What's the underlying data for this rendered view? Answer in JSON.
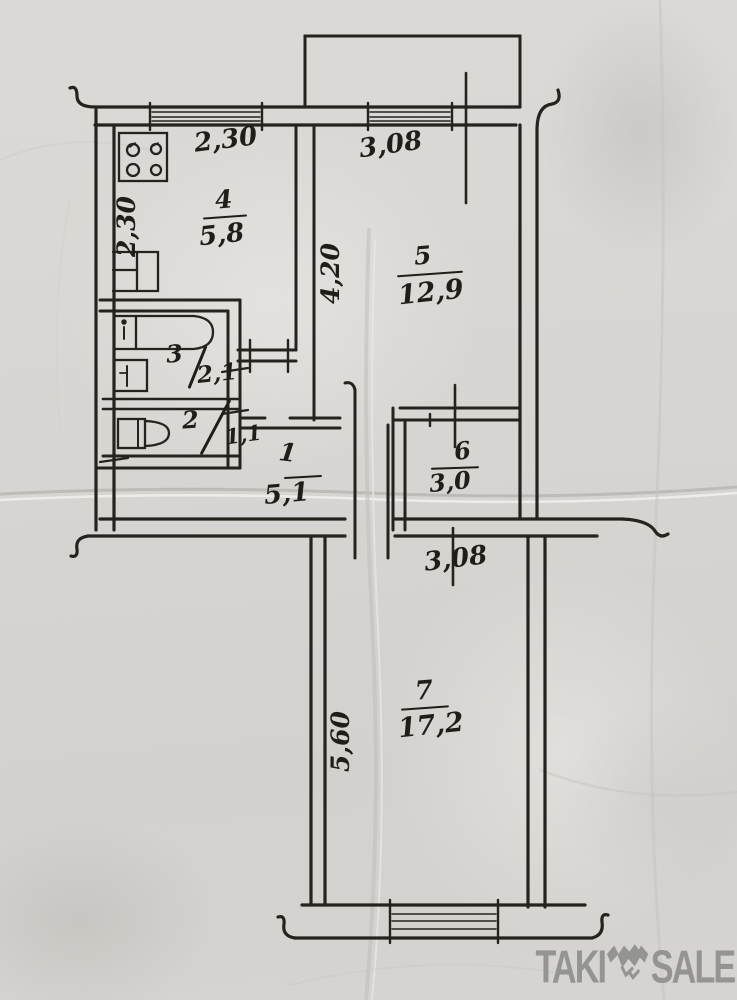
{
  "rooms": {
    "r4": {
      "number": "4",
      "area": "5,8"
    },
    "r5": {
      "number": "5",
      "area": "12,9"
    },
    "r3": {
      "number": "3",
      "area": "2,1"
    },
    "r2": {
      "number": "2",
      "area": "1,1"
    },
    "r1": {
      "number": "1",
      "area": "5,1"
    },
    "r6": {
      "number": "6",
      "area": "3,0"
    },
    "r7": {
      "number": "7",
      "area": "17,2"
    }
  },
  "dimensions": {
    "kitchen_window": "2,30",
    "kitchen_depth": "2,30",
    "room5_window": "3,08",
    "room5_depth": "4,20",
    "room7_width": "3,08",
    "room7_depth": "5,60"
  },
  "watermark": {
    "left": "TAKI",
    "right": "SALE"
  },
  "colors": {
    "ink": "#26231e",
    "paper": "#d8d6d3",
    "watermark_gray": "#8e8e8b"
  }
}
